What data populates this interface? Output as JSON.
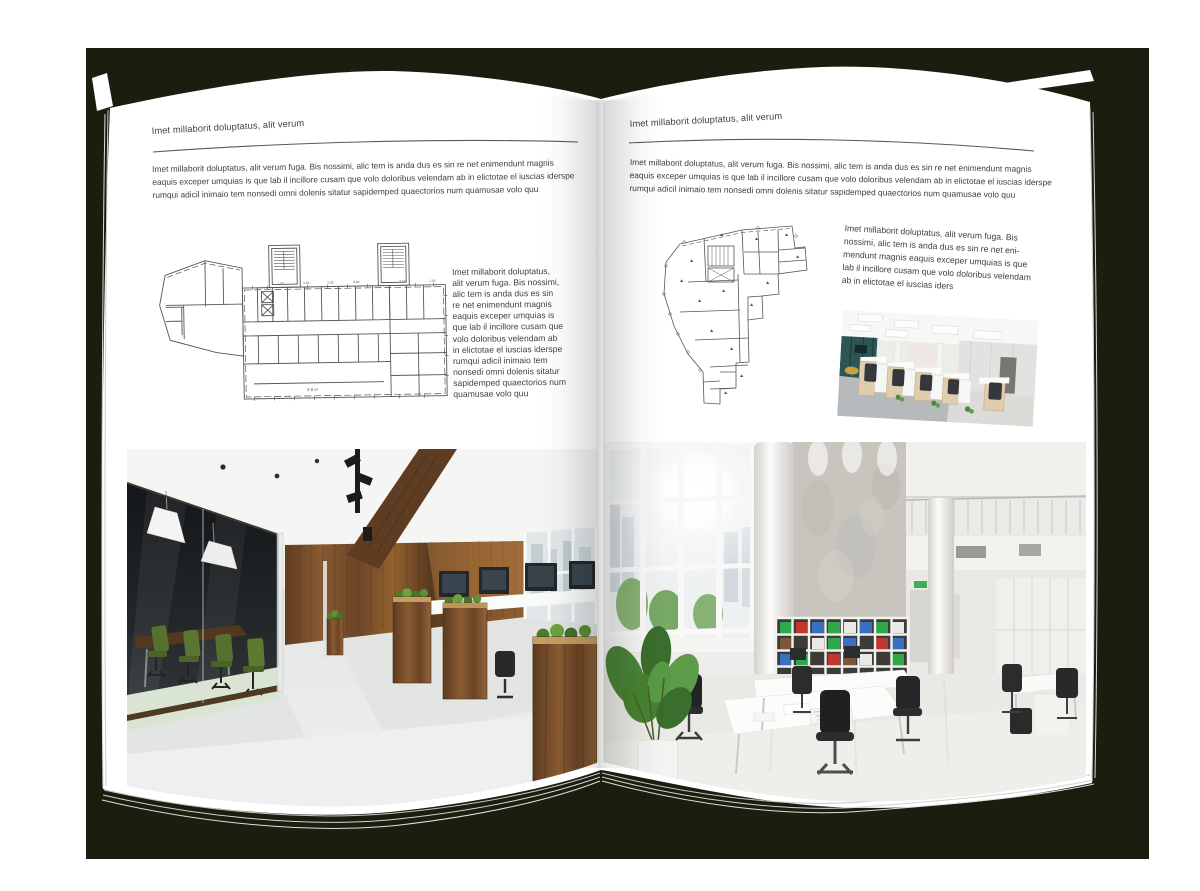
{
  "backdrop": {
    "color": "#1d1d0f"
  },
  "palette": {
    "page": "#ffffff",
    "text": "#3f3f41",
    "rule": "#58585a",
    "wood": "#7a4e2c",
    "chair_green": "#55702f",
    "binder_green": "#2fa84a",
    "binder_blue": "#3a70c0",
    "binder_red": "#bf392f"
  },
  "left_page": {
    "header": "Imet millaborit doluptatus, alit verum",
    "intro": "Imet millaborit doluptatus, alit verum fuga. Bis nossimi, alic tem is anda dus es sin re net enimendunt magnis\neaquis exceper umquias is que lab il incillore cusam que volo doloribus velendam ab in elictotae el iuscias iderspe\nrumqui adicil inimaio tem nonsedi omni dolenis sitatur sapidemped quaectorios num quamusae volo quu",
    "caption": "Imet millaborit doluptatus,\nalit verum fuga. Bis nossimi,\nalic tem is anda dus es sin\nre net enimendunt magnis\neaquis exceper umquias is\nque lab il incillore cusam que\nvolo doloribus velendam ab\nin elictotae el iuscias iderspe\nrumqui adicil inimaio tem\nnonsedi omni dolenis sitatur\nsapidemped quaectorios num\nquamusae volo quu",
    "floor_plan": {
      "label": "2-й эт",
      "annotations": [
        "1.75",
        "2.81",
        "2.93",
        "3.84",
        "3.79",
        "1.45"
      ]
    },
    "photo_alt": "dark wood and glass office interior"
  },
  "right_page": {
    "header": "Imet millaborit doluptatus, alit verum",
    "intro": "Imet millaborit doluptatus, alit verum fuga. Bis nossimi, alic tem is anda dus es sin re net enimendunt magnis\neaquis exceper umquias is que lab il incillore cusam que volo doloribus velendam ab in elictotae el iuscias iderspe\nrumqui adicil inimaio tem nonsedi omni dolenis sitatur sapidemped quaectorios num quamusae volo quu",
    "caption": "Imet millaborit doluptatus, alit verum fuga. Bis\nnossimi, alic tem is anda dus es sin re net eni-\nmendunt magnis eaquis exceper umquias is que\nlab il incillore cusam que volo doloribus velendam\nab in elictotae el iuscias iders",
    "photo_small_alt": "open plan workstation office photo",
    "photo_alt": "bright white open office interior"
  }
}
